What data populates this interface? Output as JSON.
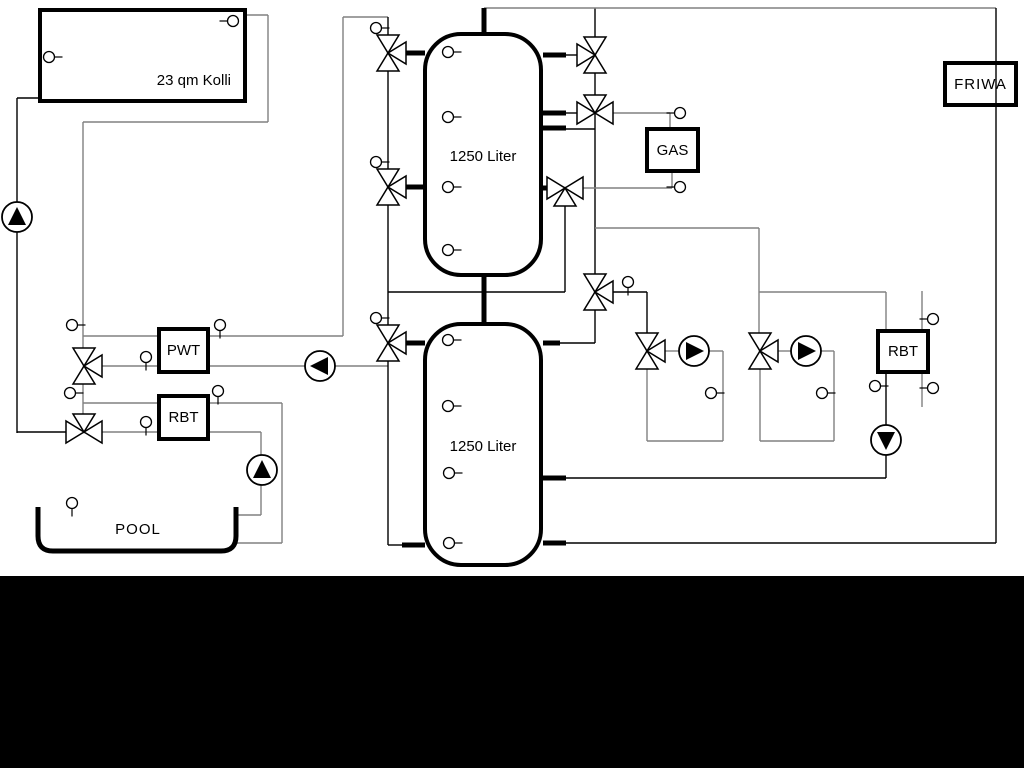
{
  "labels": {
    "collector": "23 qm Kolli",
    "tank1": "1250 Liter",
    "tank2": "1250 Liter",
    "pwt": "PWT",
    "rbt_left": "RBT",
    "rbt_right": "RBT",
    "gas": "GAS",
    "friwa": "FRIWA",
    "pool": "POOL"
  },
  "colors": {
    "background": "#ffffff",
    "line_gray": "#808080",
    "line_black": "#000000",
    "footer_band": "#000000"
  }
}
